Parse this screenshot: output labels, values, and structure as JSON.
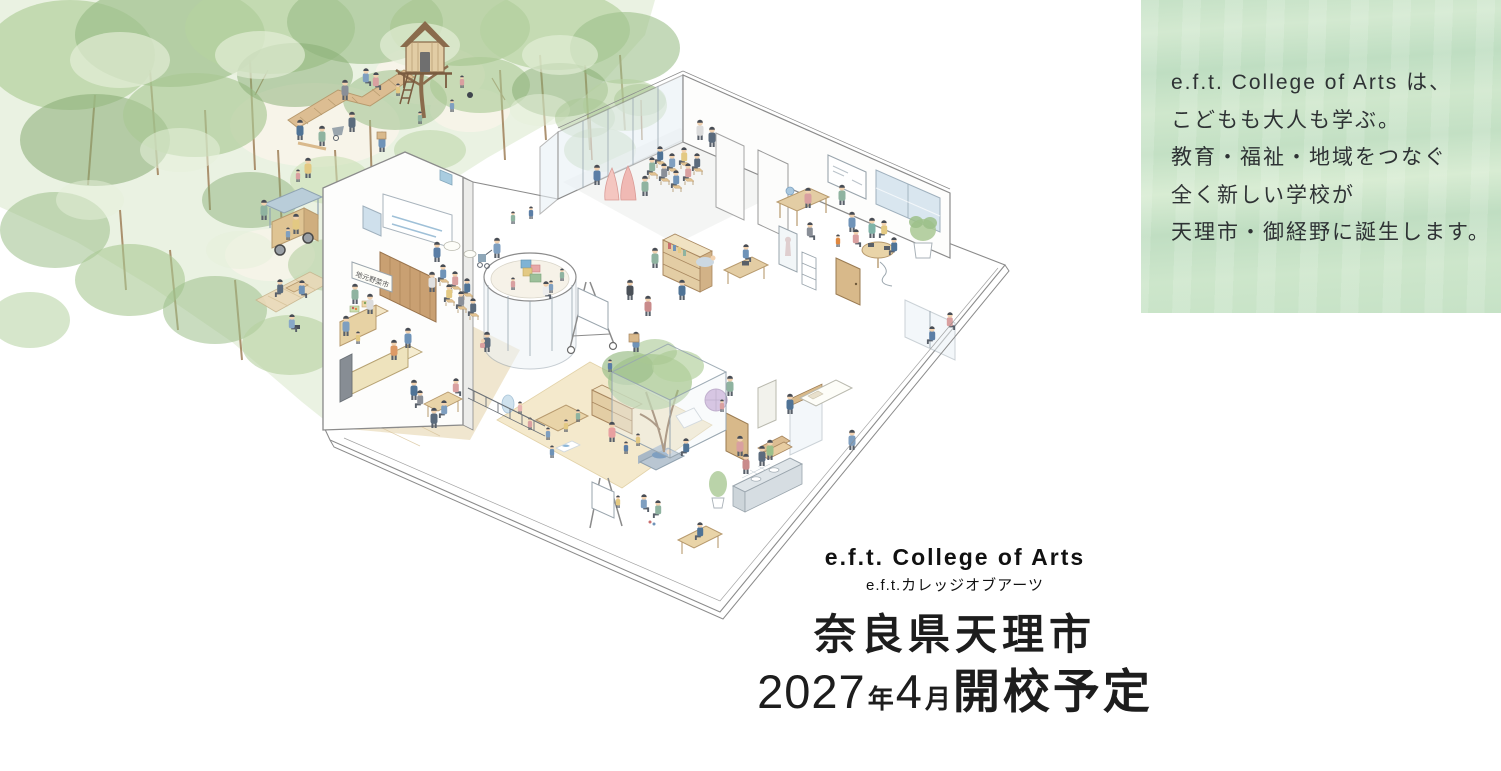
{
  "intro_panel": {
    "lines": [
      "e.f.t. College of Arts は、",
      "こどもも大人も学ぶ。",
      "教育・福祉・地域をつなぐ",
      "全く新しい学校が",
      "天理市・御経野に誕生します。"
    ],
    "background_color": "#c6e2c6",
    "text_color": "#2e3234"
  },
  "branding": {
    "school_name_en": "e.f.t. College of Arts",
    "school_name_ja": "e.f.t.カレッジオブアーツ"
  },
  "announcement": {
    "location": "奈良県天理市",
    "opening_year": "2027",
    "year_suffix": "年",
    "opening_month": "4",
    "month_suffix": "月",
    "opening_label": "開校予定"
  },
  "illustration": {
    "market_sign": "地元野菜市"
  },
  "colors": {
    "page_background": "#ffffff",
    "forest_green": "#9cbf8a",
    "panel_green": "#c6e2c6",
    "headline_text": "#1d1d1d"
  }
}
